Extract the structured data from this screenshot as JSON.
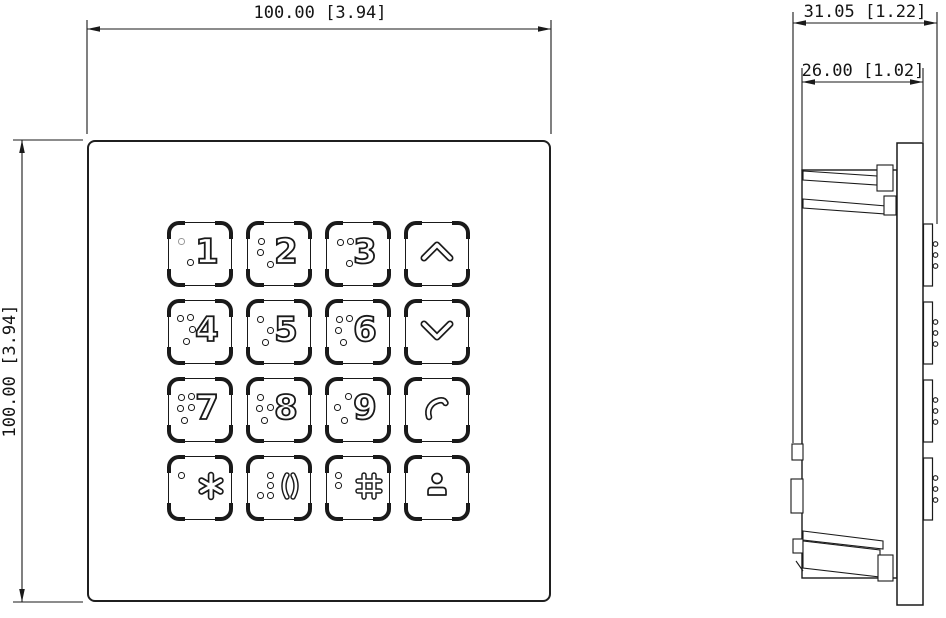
{
  "drawing": {
    "colors": {
      "line": "#1a1a1a",
      "background": "#ffffff",
      "led_dot": "#9a9a9a"
    },
    "front_view": {
      "width_dim": "100.00 [3.94]",
      "height_dim": "100.00 [3.94]",
      "keys": [
        {
          "name": "key-1",
          "label": "1",
          "braille_dots": [
            [
              24,
              42
            ]
          ],
          "led_dot": [
            15,
            21
          ]
        },
        {
          "name": "key-2",
          "label": "2",
          "braille_dots": [
            [
              16,
              21
            ],
            [
              15,
              32
            ],
            [
              25,
              44
            ]
          ]
        },
        {
          "name": "key-3",
          "label": "3",
          "braille_dots": [
            [
              16,
              22
            ],
            [
              26,
              21
            ],
            [
              25,
              43
            ]
          ]
        },
        {
          "name": "key-up",
          "icon": "arrow-up-icon"
        },
        {
          "name": "key-4",
          "label": "4",
          "braille_dots": [
            [
              14,
              20
            ],
            [
              24,
              19
            ],
            [
              26,
              31
            ],
            [
              20,
              43
            ]
          ]
        },
        {
          "name": "key-5",
          "label": "5",
          "braille_dots": [
            [
              15,
              21
            ],
            [
              25,
              32
            ],
            [
              20,
              44
            ]
          ]
        },
        {
          "name": "key-6",
          "label": "6",
          "braille_dots": [
            [
              15,
              21
            ],
            [
              25,
              20
            ],
            [
              14,
              32
            ],
            [
              19,
              44
            ]
          ]
        },
        {
          "name": "key-down",
          "icon": "arrow-down-icon"
        },
        {
          "name": "key-7",
          "label": "7",
          "braille_dots": [
            [
              15,
              21
            ],
            [
              25,
              20
            ],
            [
              14,
              32
            ],
            [
              25,
              31
            ],
            [
              18,
              44
            ]
          ]
        },
        {
          "name": "key-8",
          "label": "8",
          "braille_dots": [
            [
              15,
              21
            ],
            [
              14,
              32
            ],
            [
              25,
              31
            ],
            [
              19,
              44
            ]
          ]
        },
        {
          "name": "key-9",
          "label": "9",
          "braille_dots": [
            [
              24,
              20
            ],
            [
              13,
              31
            ],
            [
              20,
              44
            ]
          ]
        },
        {
          "name": "key-call",
          "icon": "phone-icon"
        },
        {
          "name": "key-star",
          "icon": "asterisk-icon",
          "braille_dots": [
            [
              15,
              21
            ]
          ]
        },
        {
          "name": "key-0",
          "icon": "parentheses-icon",
          "braille_dots": [
            [
              25,
              21
            ],
            [
              25,
              31
            ],
            [
              25,
              41
            ],
            [
              15,
              41
            ]
          ]
        },
        {
          "name": "key-hash",
          "icon": "hash-icon",
          "braille_dots": [
            [
              14,
              21
            ],
            [
              14,
              31
            ]
          ]
        },
        {
          "name": "key-concierge",
          "icon": "person-icon"
        }
      ]
    },
    "side_view": {
      "total_depth_dim": "31.05 [1.22]",
      "mount_depth_dim": "26.00 [1.02]"
    }
  }
}
